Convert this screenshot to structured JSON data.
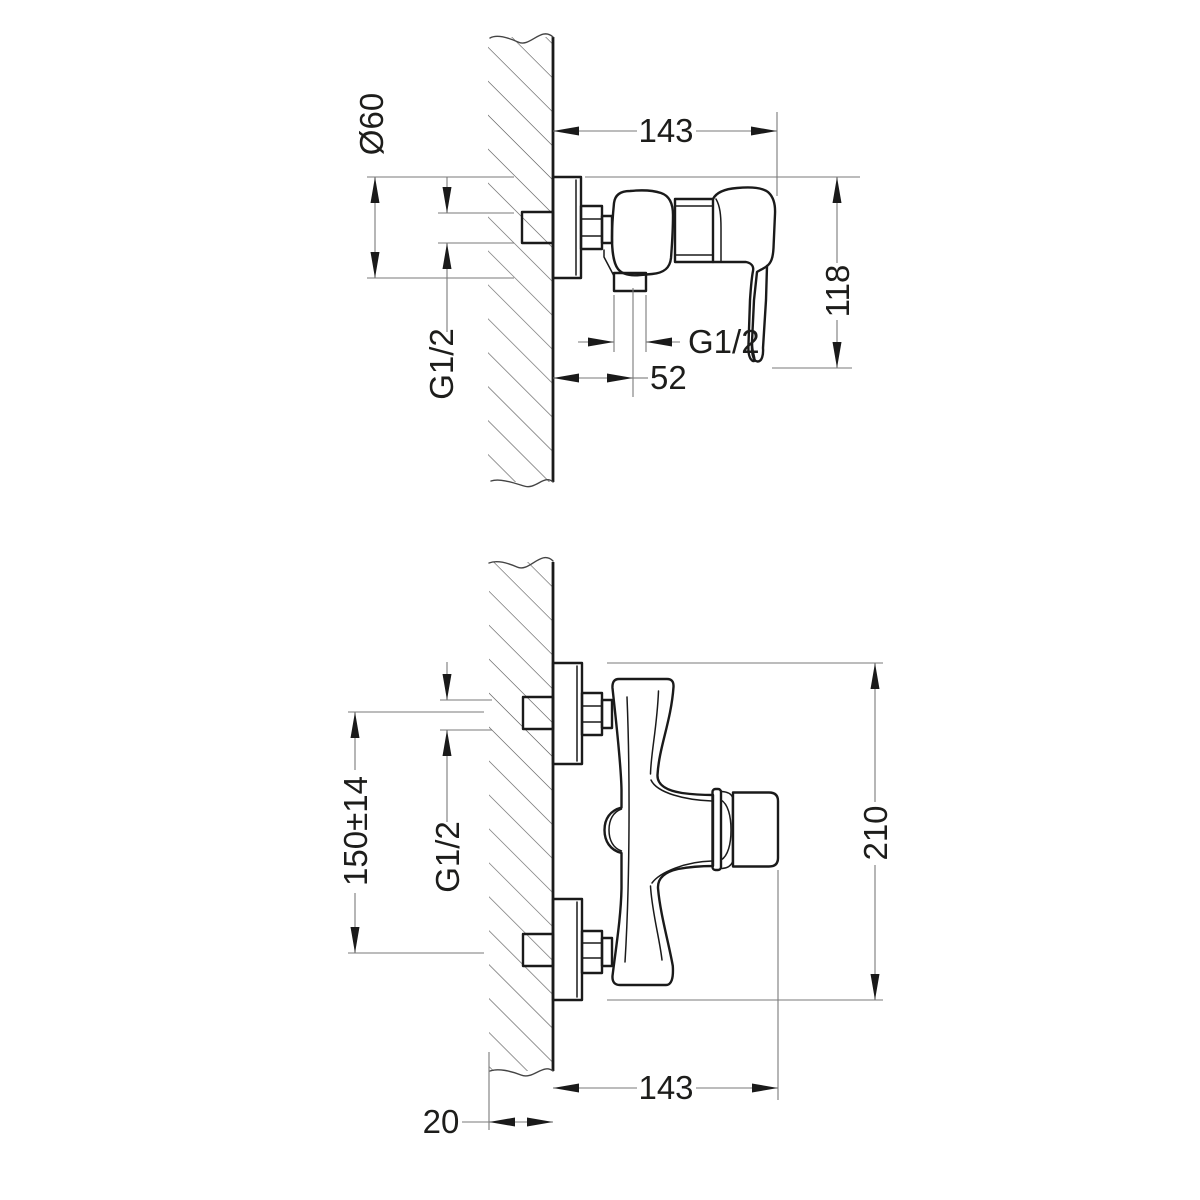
{
  "drawing_type": "technical-dimension-drawing",
  "subject": "wall-mounted-single-lever-shower-mixer",
  "views": {
    "side_view": {
      "dims": {
        "width": "143",
        "flange_diameter": "Ø60",
        "height": "118",
        "inlet_thread": "G1/2",
        "outlet_thread": "G1/2",
        "outlet_offset": "52"
      }
    },
    "front_view": {
      "dims": {
        "hole_spacing": "150±14",
        "inlet_thread": "G1/2",
        "height": "210",
        "width": "143",
        "wall_depth": "20"
      }
    }
  },
  "colors": {
    "background": "#ffffff",
    "outline": "#1a1a1a",
    "dimline": "#7a7a7a",
    "text": "#1d1d1b",
    "hatch": "#5a5a5a"
  }
}
